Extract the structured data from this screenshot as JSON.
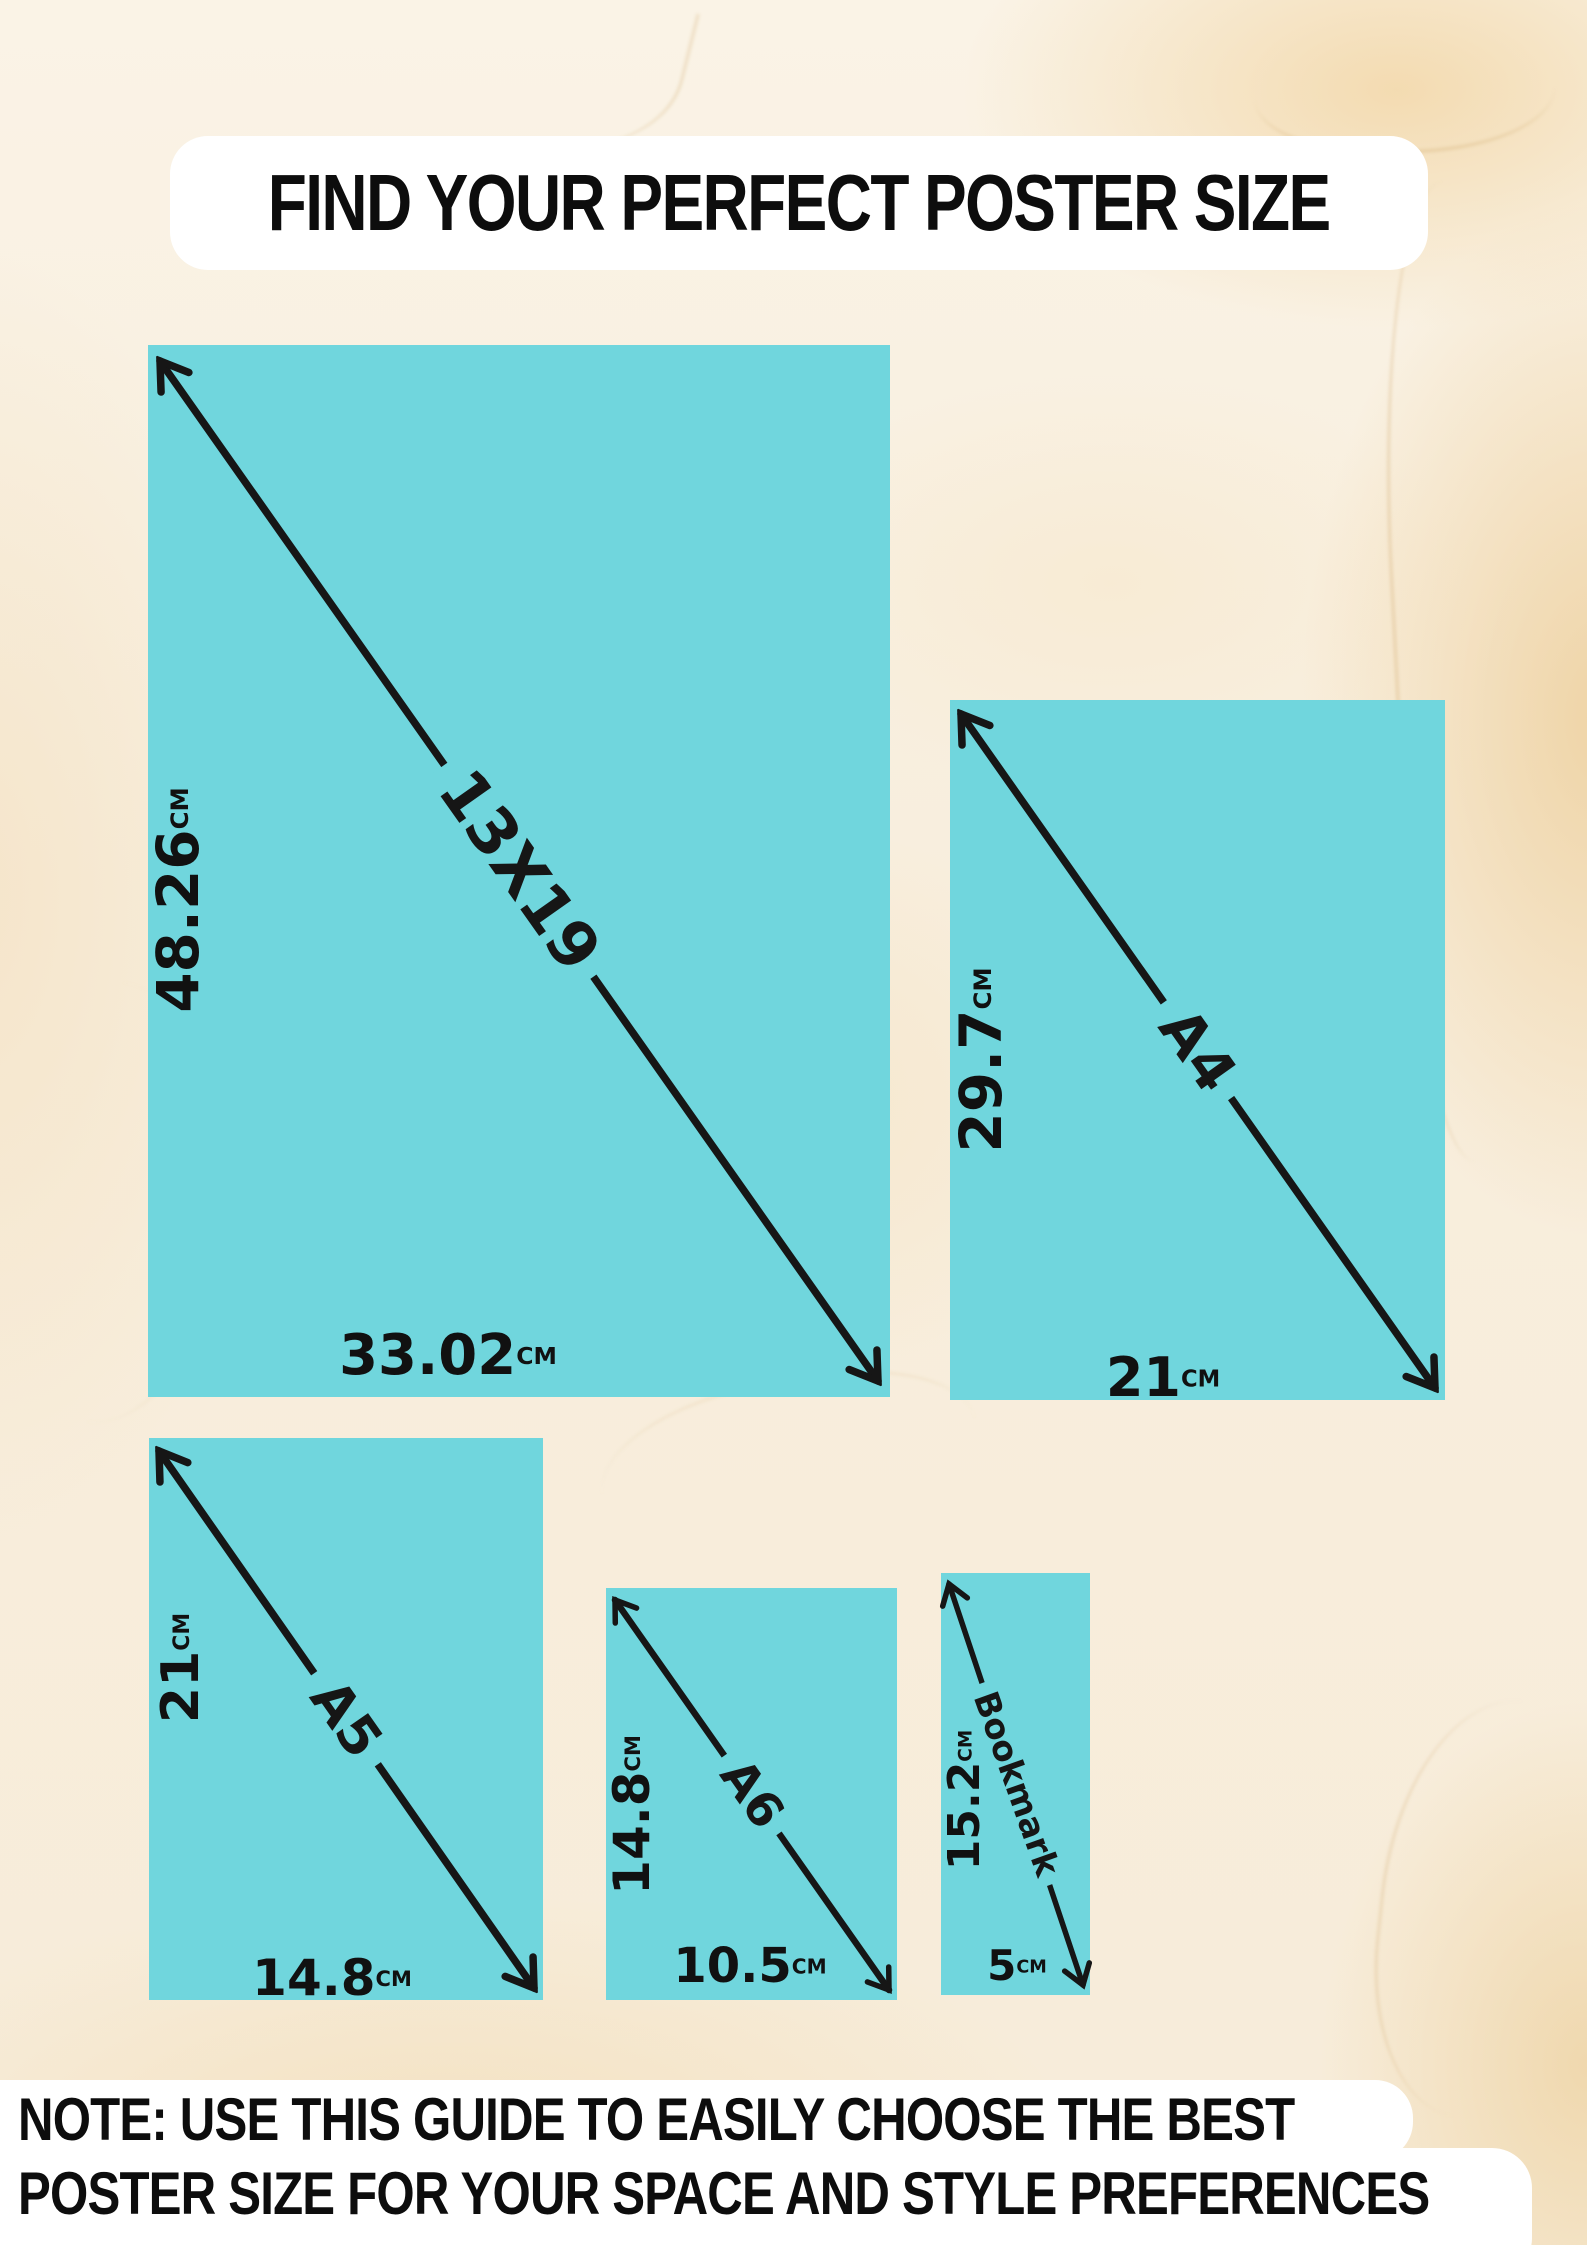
{
  "title": "FIND YOUR PERFECT POSTER SIZE",
  "note": {
    "line1": "NOTE: USE THIS GUIDE TO EASILY CHOOSE THE BEST",
    "line2": "POSTER SIZE FOR YOUR SPACE AND STYLE PREFERENCES"
  },
  "colors": {
    "paper_teal": "#70d6dd",
    "background_cream": "#f8eedd",
    "marble_vein_tan": "#cda569",
    "ink_black": "#161616",
    "pill_white": "#ffffff"
  },
  "sizes": [
    {
      "name": "13X19",
      "height": "48.26",
      "height_unit": "CM",
      "width": "33.02",
      "width_unit": "CM"
    },
    {
      "name": "A4",
      "height": "29.7",
      "height_unit": "CM",
      "width": "21",
      "width_unit": "CM"
    },
    {
      "name": "A5",
      "height": "21",
      "height_unit": "CM",
      "width": "14.8",
      "width_unit": "CM"
    },
    {
      "name": "A6",
      "height": "14.8",
      "height_unit": "CM",
      "width": "10.5",
      "width_unit": "CM"
    },
    {
      "name": "Bookmark",
      "height": "15.2",
      "height_unit": "CM",
      "width": "5",
      "width_unit": "CM"
    }
  ]
}
